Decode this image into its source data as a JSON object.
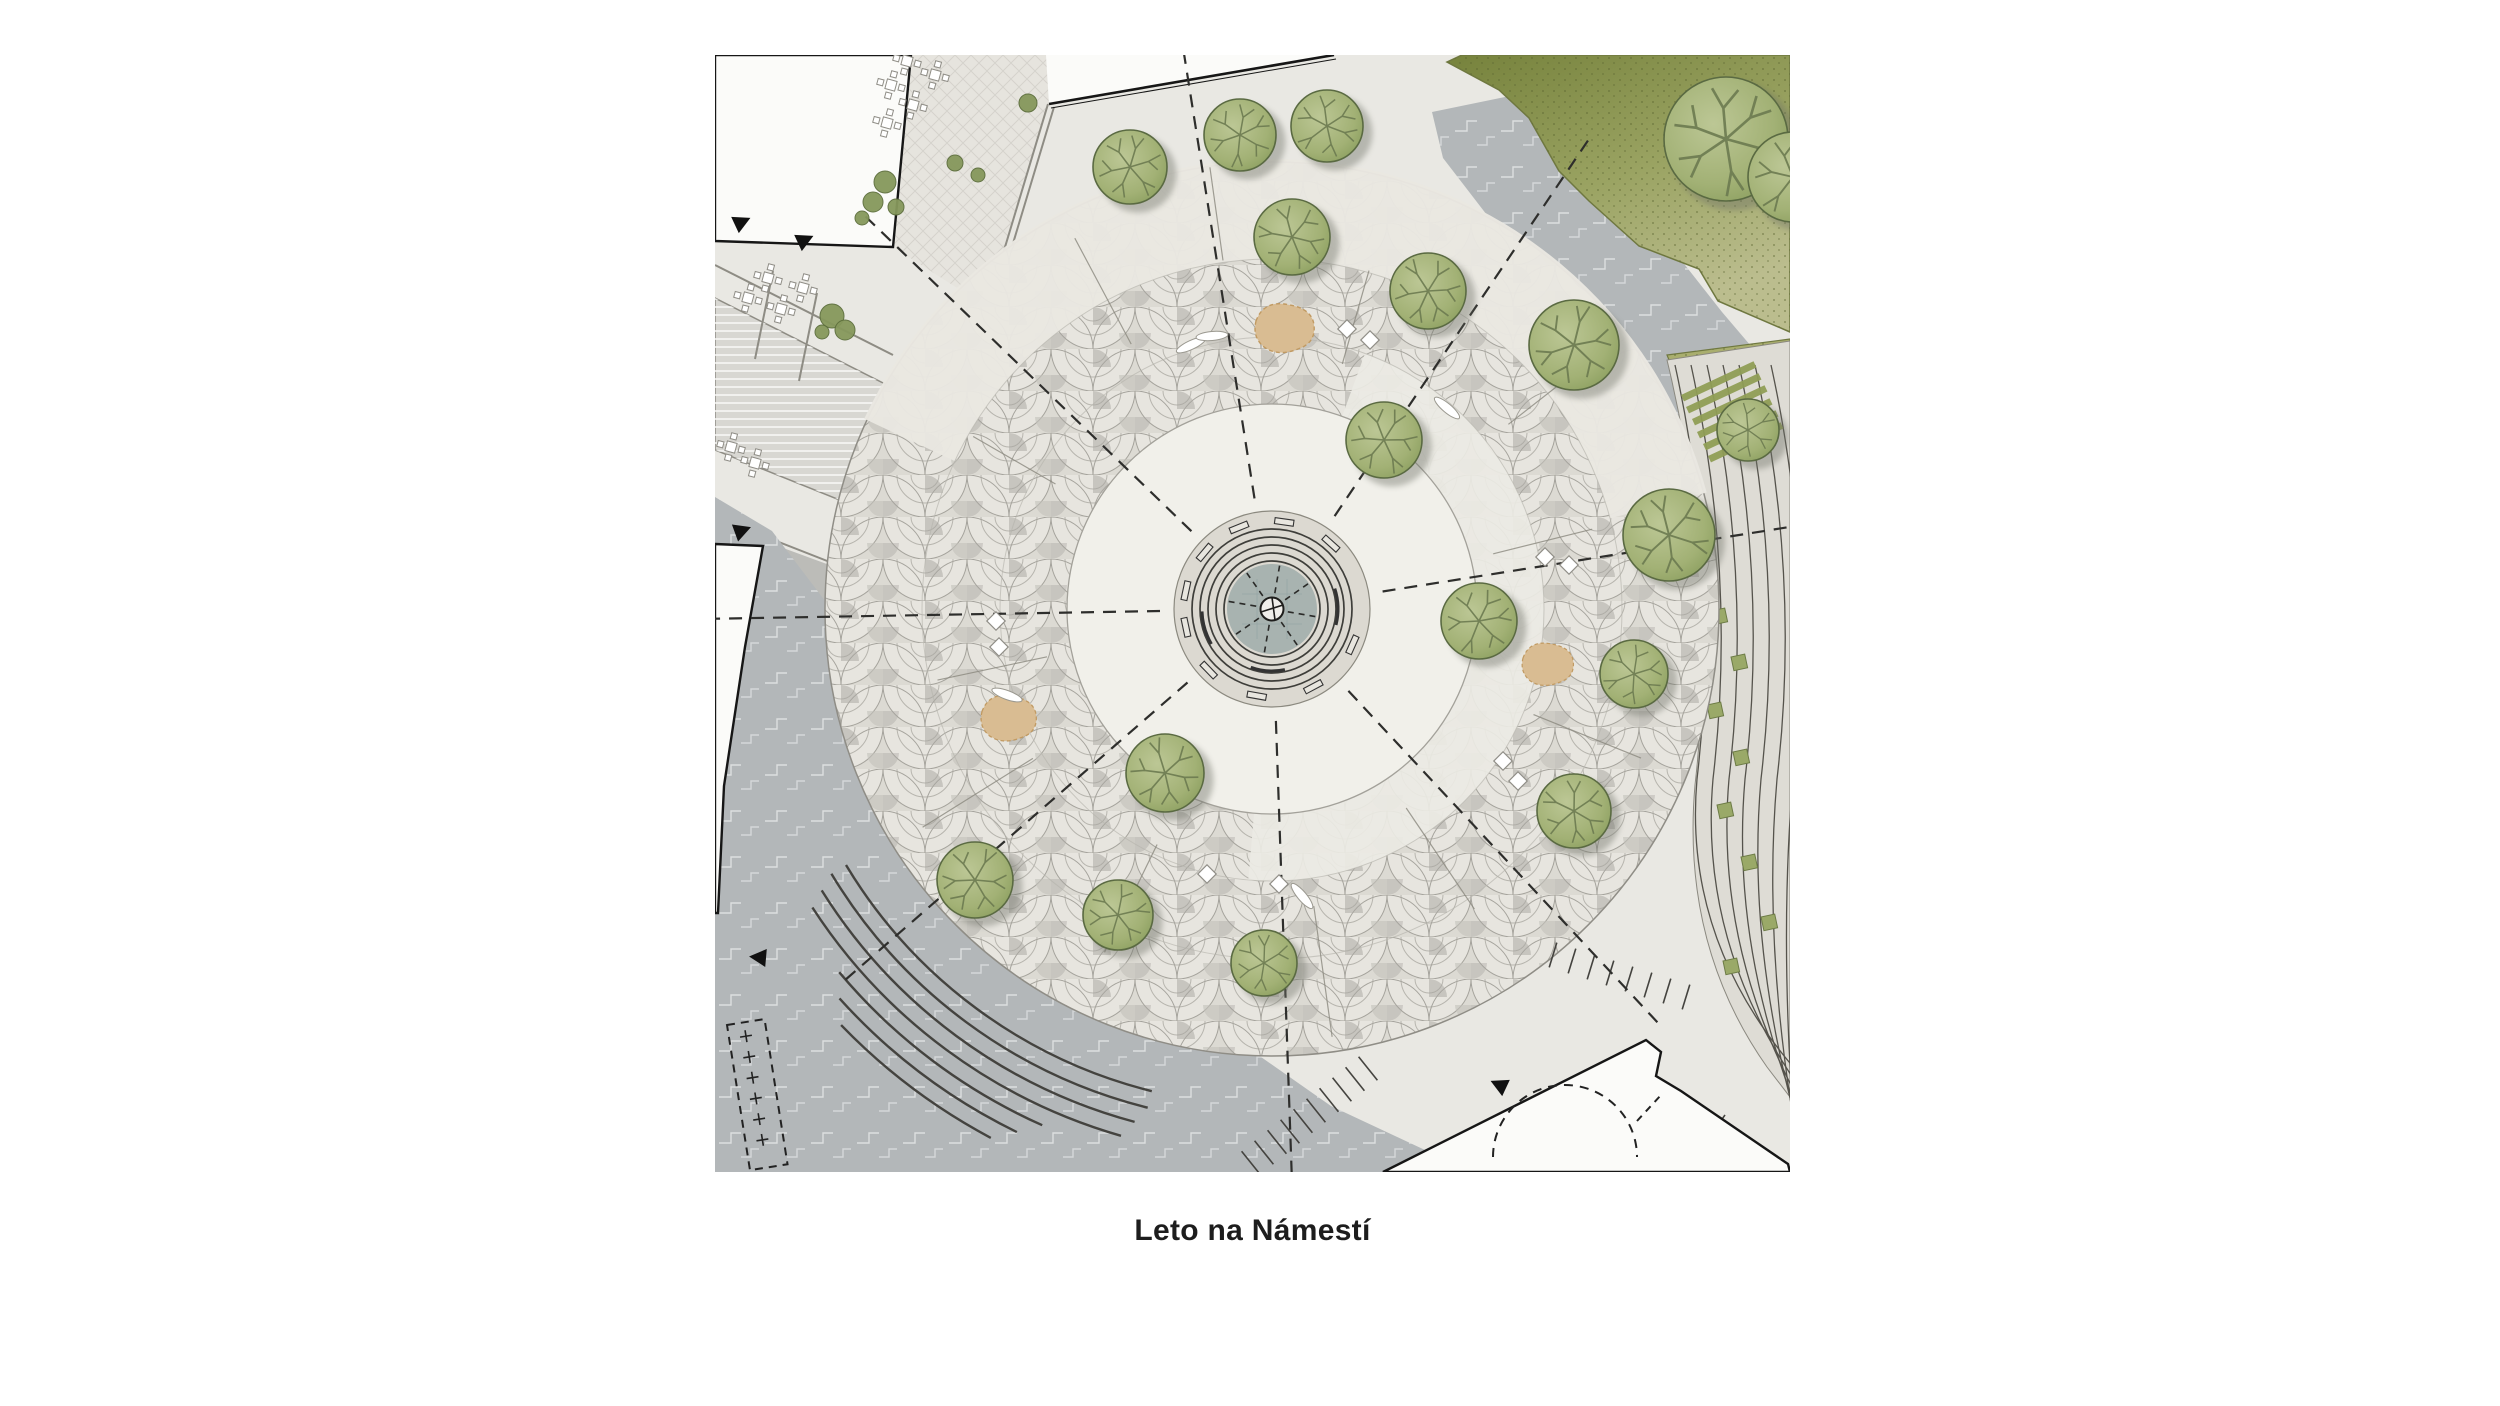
{
  "caption": {
    "text": "Leto na Námestí"
  },
  "plan": {
    "colors": {
      "base": "#e9e8e3",
      "road": "#b3b7b9",
      "road_joint": "#ffffff",
      "scallop_light": "#e7e5df",
      "scallop_mid": "#dcdad3",
      "scallop_dark": "#a3a29b",
      "inner_circle": "#f1f0ea",
      "walkway": "#e9e7e1",
      "spiral_band": "#eceae4",
      "lawn_dark": "#7c883f",
      "lawn_light": "#b9bb8b",
      "pocket": "#a9ae6e",
      "terrace": "#dedcd5",
      "terrace_line": "#55534c",
      "terrace_strip": "#8f9d55",
      "terrace_square": "#9aa968",
      "tree_light": "#b9c492",
      "tree_dark": "#8fa263",
      "tree_stroke": "#5a6a42",
      "branch": "#6b7a50",
      "shrub": "#86985c",
      "building": "#fbfbf9",
      "outline": "#161616",
      "water": "#a2aeac",
      "tan": "#d9bc92",
      "tan_stroke": "#c19a62",
      "step_line": "#44433f",
      "dash_line": "#2e2e2c",
      "joint_line": "#8b897f",
      "street_line": "#8e8c84",
      "crossing": "#d8d7d2",
      "sidewalk": "#bcbcb8",
      "furniture_stroke": "#8f8d86"
    },
    "center": [
      557,
      554
    ],
    "radii": {
      "plaza": 447,
      "inner": 205,
      "ring2": 272,
      "ring3": 350
    },
    "walkway_band": {
      "r1": 350,
      "r2": 450,
      "a1": -155,
      "a2": -15
    },
    "spiral_band": {
      "r1": 205,
      "r2": 272,
      "a1": -70,
      "a2": 95
    },
    "roadA": [
      [
        717,
        57
      ],
      [
        814,
        37
      ],
      [
        868,
        91
      ],
      [
        933,
        163
      ],
      [
        1007,
        257
      ],
      [
        1075,
        337
      ],
      [
        1075,
        492
      ],
      [
        985,
        427
      ],
      [
        885,
        307
      ],
      [
        785,
        177
      ],
      [
        728,
        103
      ]
    ],
    "roadB": [
      [
        0,
        442
      ],
      [
        57,
        476
      ],
      [
        186,
        646
      ],
      [
        366,
        851
      ],
      [
        516,
        981
      ],
      [
        616,
        1051
      ],
      [
        757,
        1117
      ],
      [
        0,
        1117
      ]
    ],
    "lawn": [
      [
        747,
        0
      ],
      [
        1075,
        0
      ],
      [
        1075,
        277
      ],
      [
        1003,
        246
      ],
      [
        984,
        214
      ],
      [
        924,
        191
      ],
      [
        874,
        146
      ],
      [
        844,
        116
      ],
      [
        814,
        63
      ],
      [
        784,
        35
      ],
      [
        732,
        7
      ]
    ],
    "pocket": [
      [
        952,
        300
      ],
      [
        1075,
        284
      ],
      [
        1075,
        432
      ],
      [
        1002,
        422
      ]
    ],
    "terrace_region": "M952,305 Q1004,520 980,730 Q966,890 1052,1012 L1075,1042 L1075,286 Z",
    "terrace_arcs": {
      "n": 7,
      "x0": 960,
      "dx": 16,
      "end_y0": 1014,
      "end_dy": 12
    },
    "terrace_strips": [
      [
        966,
        340
      ],
      [
        971,
        352
      ],
      [
        977,
        364
      ],
      [
        982,
        377
      ],
      [
        988,
        389
      ],
      [
        993,
        401
      ]
    ],
    "terrace_squares": [
      [
        996,
        556
      ],
      [
        1016,
        602
      ],
      [
        992,
        650
      ],
      [
        1018,
        697
      ],
      [
        1002,
        750
      ],
      [
        1026,
        802
      ],
      [
        1046,
        862
      ],
      [
        1008,
        906
      ]
    ],
    "diag_street": [
      [
        196,
        0
      ],
      [
        331,
        0
      ],
      [
        334,
        49
      ],
      [
        272,
        252
      ],
      [
        178,
        192
      ]
    ],
    "crossing": [
      [
        0,
        243
      ],
      [
        172,
        330
      ],
      [
        142,
        452
      ],
      [
        0,
        395
      ]
    ],
    "sidewalk": [
      [
        0,
        468
      ],
      [
        150,
        523
      ],
      [
        132,
        562
      ],
      [
        0,
        505
      ]
    ],
    "street_lines": [
      [
        [
          333,
          49
        ],
        [
          272,
          252
        ]
      ],
      [
        [
          339,
          52
        ],
        [
          278,
          255
        ]
      ],
      [
        [
          0,
          210
        ],
        [
          178,
          300
        ]
      ],
      [
        [
          58,
          216
        ],
        [
          40,
          304
        ]
      ],
      [
        [
          102,
          238
        ],
        [
          84,
          326
        ]
      ],
      [
        [
          0,
          462
        ],
        [
          148,
          520
        ]
      ]
    ],
    "buildings": {
      "b1": [
        [
          0,
          0
        ],
        [
          196,
          0
        ],
        [
          178,
          192
        ],
        [
          0,
          186
        ]
      ],
      "b2": [
        [
          331,
          0
        ],
        [
          619,
          0
        ],
        [
          334,
          49
        ]
      ],
      "b2_edge": [
        [
          619,
          0
        ],
        [
          334,
          49
        ]
      ],
      "b3": [
        [
          0,
          489
        ],
        [
          48,
          491
        ],
        [
          30,
          592
        ],
        [
          9,
          731
        ],
        [
          3,
          858
        ],
        [
          0,
          858
        ]
      ],
      "b4": [
        [
          931,
          985
        ],
        [
          946,
          997
        ],
        [
          941,
          1021
        ],
        [
          966,
          1036
        ],
        [
          1073,
          1109
        ],
        [
          1075,
          1117
        ],
        [
          668,
          1117
        ]
      ],
      "b4_arc": "M778,1102 A72,72 0 0 1 922,1102",
      "b4_dash": [
        [
          922,
          1066
        ],
        [
          946,
          1040
        ]
      ]
    },
    "trees": [
      [
        415,
        112,
        37
      ],
      [
        525,
        80,
        36
      ],
      [
        612,
        71,
        36
      ],
      [
        577,
        182,
        38
      ],
      [
        713,
        236,
        38
      ],
      [
        859,
        290,
        45
      ],
      [
        1033,
        375,
        31
      ],
      [
        954,
        480,
        46
      ],
      [
        669,
        385,
        38
      ],
      [
        764,
        566,
        38
      ],
      [
        919,
        619,
        34
      ],
      [
        859,
        756,
        37
      ],
      [
        450,
        718,
        39
      ],
      [
        260,
        825,
        38
      ],
      [
        403,
        860,
        35
      ],
      [
        549,
        908,
        33
      ],
      [
        1011,
        84,
        62
      ],
      [
        1078,
        122,
        45
      ]
    ],
    "shrubs": [
      [
        170,
        127,
        11
      ],
      [
        158,
        147,
        10
      ],
      [
        181,
        152,
        8
      ],
      [
        147,
        163,
        7
      ],
      [
        117,
        261,
        12
      ],
      [
        130,
        275,
        10
      ],
      [
        107,
        277,
        7
      ],
      [
        240,
        108,
        8
      ],
      [
        263,
        120,
        7
      ],
      [
        313,
        48,
        9
      ]
    ],
    "tables": [
      [
        192,
        6
      ],
      [
        220,
        20
      ],
      [
        176,
        30
      ],
      [
        198,
        50
      ],
      [
        172,
        68
      ],
      [
        53,
        223
      ],
      [
        88,
        233
      ],
      [
        33,
        243
      ],
      [
        66,
        254
      ],
      [
        16,
        392
      ],
      [
        40,
        408
      ]
    ],
    "diamonds": [
      [
        632,
        274
      ],
      [
        655,
        285
      ],
      [
        830,
        502
      ],
      [
        854,
        510
      ],
      [
        788,
        706
      ],
      [
        803,
        726
      ],
      [
        281,
        566
      ],
      [
        284,
        592
      ],
      [
        492,
        819
      ],
      [
        564,
        829
      ]
    ],
    "leaves": [
      [
        476,
        290,
        -25
      ],
      [
        497,
        281,
        -5
      ],
      [
        732,
        353,
        40
      ],
      [
        292,
        640,
        20
      ],
      [
        587,
        841,
        50
      ]
    ],
    "patches": [
      [
        571,
        274,
        30
      ],
      [
        834,
        610,
        26
      ],
      [
        295,
        664,
        28
      ]
    ],
    "dashed_radials": {
      "angles": [
        179,
        -136,
        -99,
        -56,
        -9,
        47,
        88,
        139
      ],
      "r1": 112,
      "r2": 568
    },
    "joints": [
      [
        -150,
        250,
        345
      ],
      [
        -118,
        300,
        420
      ],
      [
        -74,
        255,
        352
      ],
      [
        -38,
        300,
        430
      ],
      [
        -14,
        228,
        330
      ],
      [
        22,
        282,
        398
      ],
      [
        56,
        240,
        362
      ],
      [
        82,
        300,
        432
      ],
      [
        116,
        262,
        382
      ],
      [
        148,
        282,
        412
      ],
      [
        168,
        230,
        342
      ],
      [
        -98,
        352,
        446
      ]
    ],
    "curved_steps": [
      [
        497,
        104,
        149
      ],
      [
        514,
        104,
        149
      ],
      [
        531,
        105,
        148
      ],
      [
        548,
        106,
        147
      ],
      [
        565,
        114,
        140
      ],
      [
        582,
        116,
        138
      ],
      [
        599,
        118,
        136
      ]
    ],
    "stairs": [
      {
        "x0": 536,
        "y0": 1108,
        "dx": 13,
        "dy": -10.5,
        "len": 30,
        "ang": 51,
        "n": 10
      },
      {
        "x0": 838,
        "y0": 900,
        "dx": 19,
        "dy": 6,
        "len": 26,
        "ang": 107,
        "n": 8
      },
      {
        "x0": 902,
        "y0": 1112,
        "dx": 15,
        "dy": -1,
        "len": 115,
        "ang": -55,
        "n": 6
      }
    ],
    "fountain": {
      "base_r": 98,
      "rings": [
        80,
        72,
        64,
        56,
        48
      ],
      "water_r": 45,
      "bench_angles": [
        -168,
        -140,
        -112,
        -82,
        -48,
        24,
        62,
        100,
        136,
        168
      ],
      "bench_r": 88,
      "arc_benches": [
        [
          66,
          -18,
          14
        ],
        [
          62,
          78,
          110
        ],
        [
          70,
          150,
          178
        ]
      ],
      "ray_angles": [
        10,
        55,
        100,
        145,
        190,
        235,
        280,
        325
      ],
      "hub_r": 11.5
    },
    "arrows": [
      [
        20,
        170,
        -25
      ],
      [
        83,
        188,
        -25
      ],
      [
        20,
        478,
        -20
      ],
      [
        51,
        903,
        185
      ],
      [
        791,
        1033,
        205
      ]
    ],
    "parking_strip": {
      "x": 12,
      "y": 970,
      "w": 38,
      "h": 147,
      "rot": -9,
      "marks": 6
    }
  }
}
